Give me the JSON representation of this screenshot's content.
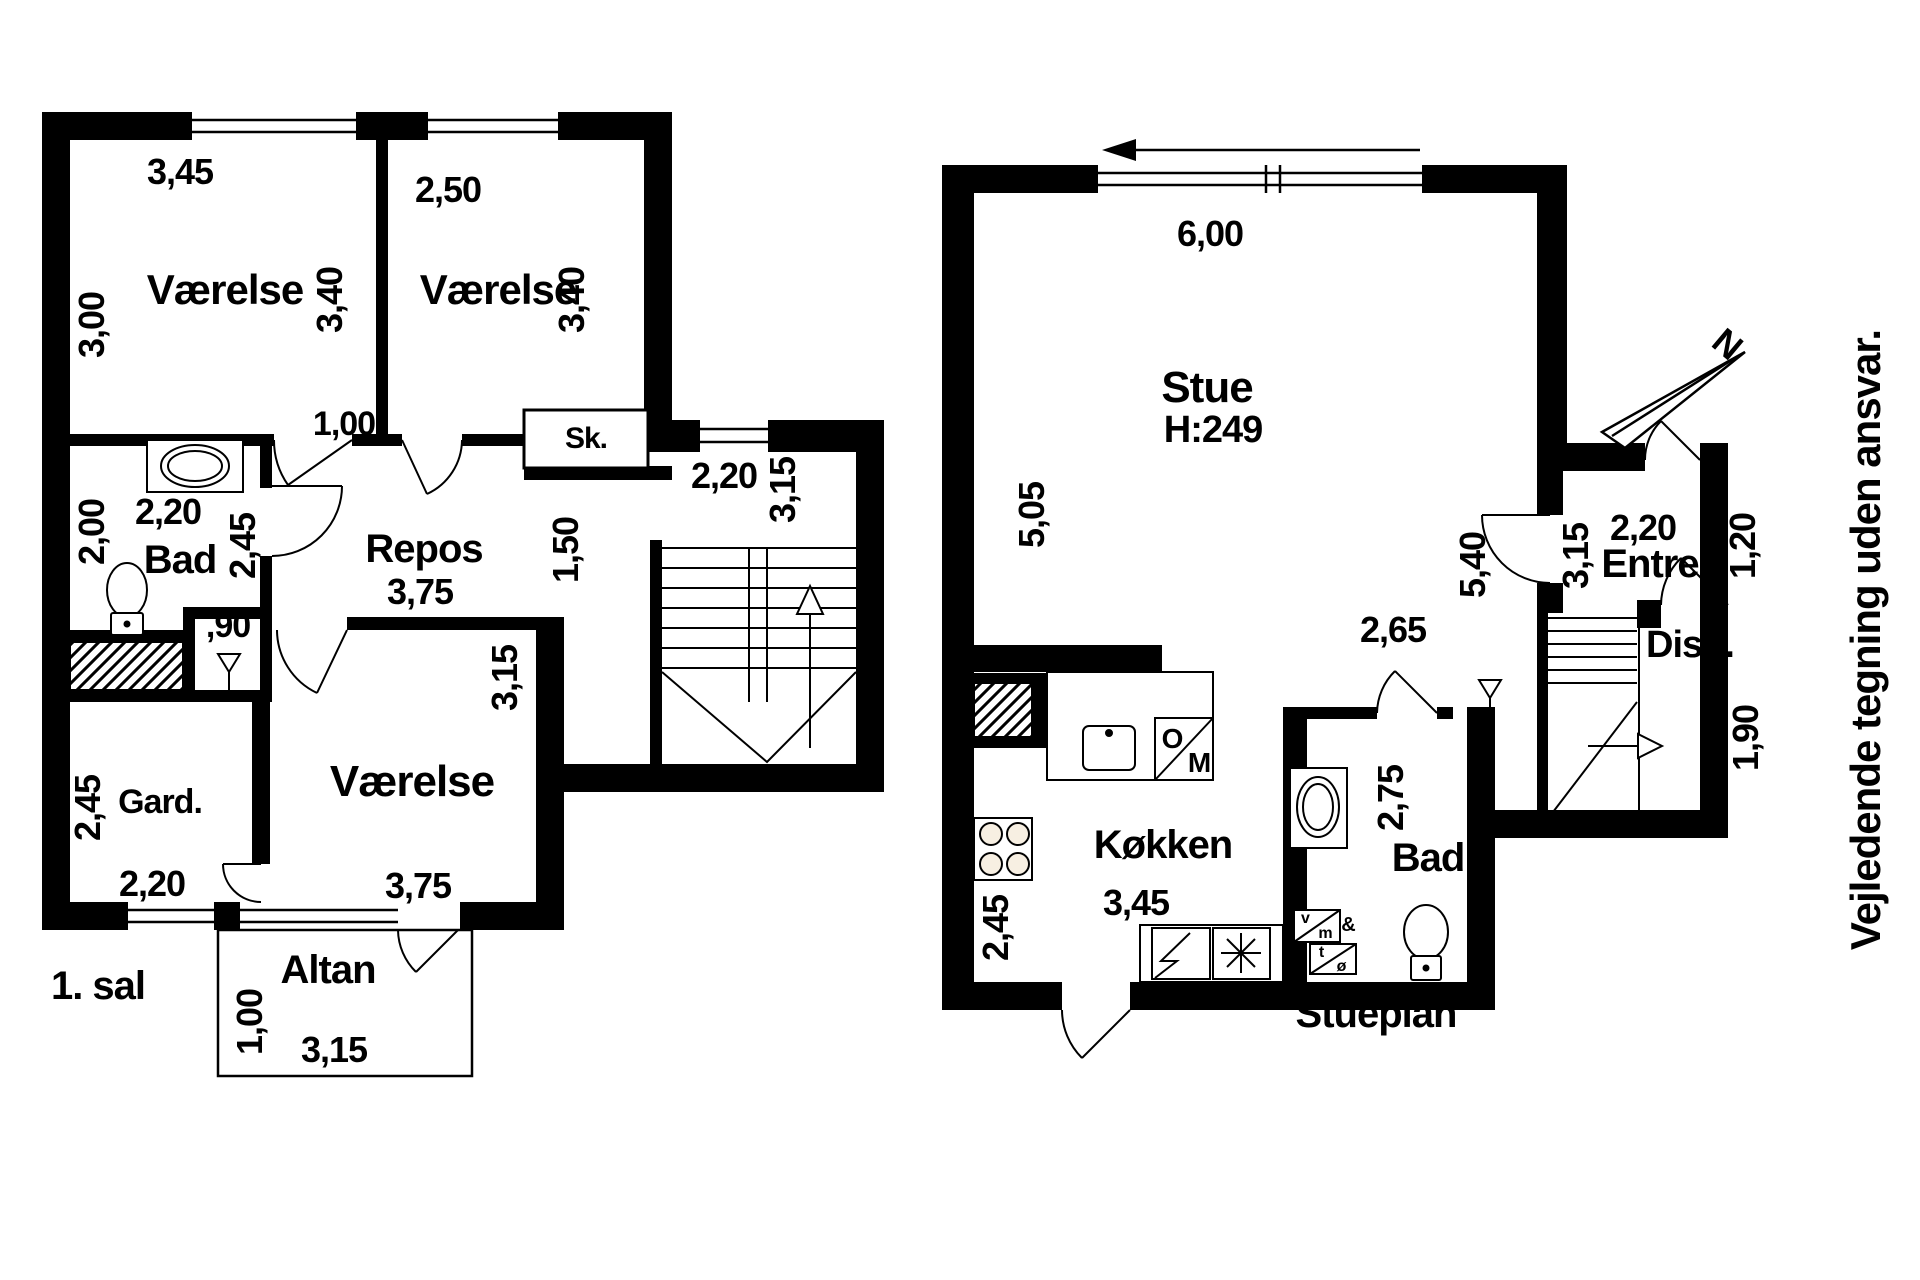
{
  "drawing_type": "floor-plan",
  "colors": {
    "ink": "#000000",
    "paper": "#ffffff",
    "burner_fill": "#f7efe2"
  },
  "first_floor": {
    "title": "1. sal",
    "labels": [
      {
        "name": "room1-width-dim",
        "text": "3,45",
        "x": 180,
        "y": 172,
        "size": 36
      },
      {
        "name": "room1-label",
        "text": "Værelse",
        "x": 225,
        "y": 290,
        "size": 42
      },
      {
        "name": "room1-depth-dim",
        "text": "3,00",
        "x": 92,
        "y": 325,
        "size": 36,
        "rot": -90
      },
      {
        "name": "room1-right-dim",
        "text": "3,40",
        "x": 330,
        "y": 300,
        "size": 36,
        "rot": -90
      },
      {
        "name": "room2-width-dim",
        "text": "2,50",
        "x": 448,
        "y": 190,
        "size": 36
      },
      {
        "name": "room2-label",
        "text": "Værelse",
        "x": 498,
        "y": 290,
        "size": 42
      },
      {
        "name": "room2-right-dim",
        "text": "3,40",
        "x": 572,
        "y": 300,
        "size": 36,
        "rot": -90
      },
      {
        "name": "closet-label",
        "text": "Sk.",
        "x": 586,
        "y": 439,
        "size": 30
      },
      {
        "name": "door-width-dim",
        "text": "1,00",
        "x": 344,
        "y": 424,
        "size": 34
      },
      {
        "name": "bath1-width-dim",
        "text": "2,20",
        "x": 168,
        "y": 512,
        "size": 36
      },
      {
        "name": "bath1-label",
        "text": "Bad",
        "x": 180,
        "y": 560,
        "size": 40
      },
      {
        "name": "bath1-left-dim",
        "text": "2,00",
        "x": 92,
        "y": 532,
        "size": 36,
        "rot": -90
      },
      {
        "name": "bath1-right-dim",
        "text": "2,45",
        "x": 243,
        "y": 546,
        "size": 36,
        "rot": -90
      },
      {
        "name": "niche-width-dim",
        "text": ",90",
        "x": 228,
        "y": 626,
        "size": 34
      },
      {
        "name": "repos-label",
        "text": "Repos",
        "x": 424,
        "y": 549,
        "size": 40
      },
      {
        "name": "repos-width-dim",
        "text": "3,75",
        "x": 420,
        "y": 592,
        "size": 36
      },
      {
        "name": "corridor-dim",
        "text": "1,50",
        "x": 566,
        "y": 550,
        "size": 36,
        "rot": -90
      },
      {
        "name": "stair-width-dim",
        "text": "2,20",
        "x": 724,
        "y": 476,
        "size": 36
      },
      {
        "name": "stair-depth-dim",
        "text": "3,15",
        "x": 783,
        "y": 490,
        "size": 36,
        "rot": -90
      },
      {
        "name": "gard-label",
        "text": "Gard.",
        "x": 160,
        "y": 802,
        "size": 34
      },
      {
        "name": "gard-depth-dim",
        "text": "2,45",
        "x": 88,
        "y": 808,
        "size": 36,
        "rot": -90
      },
      {
        "name": "gard-width-dim",
        "text": "2,20",
        "x": 152,
        "y": 884,
        "size": 36
      },
      {
        "name": "room3-label",
        "text": "Værelse",
        "x": 412,
        "y": 782,
        "size": 44
      },
      {
        "name": "room3-width-dim",
        "text": "3,75",
        "x": 418,
        "y": 886,
        "size": 36
      },
      {
        "name": "room3-right-dim",
        "text": "3,15",
        "x": 505,
        "y": 678,
        "size": 36,
        "rot": -90
      },
      {
        "name": "altan-label",
        "text": "Altan",
        "x": 328,
        "y": 970,
        "size": 40
      },
      {
        "name": "altan-depth-dim",
        "text": "1,00",
        "x": 250,
        "y": 1022,
        "size": 36,
        "rot": -90
      },
      {
        "name": "altan-width-dim",
        "text": "3,15",
        "x": 334,
        "y": 1050,
        "size": 36
      }
    ]
  },
  "ground_floor": {
    "title": "Stueplan",
    "labels": [
      {
        "name": "stue-width-dim",
        "text": "6,00",
        "x": 1210,
        "y": 234,
        "size": 36
      },
      {
        "name": "stue-label",
        "text": "Stue",
        "x": 1207,
        "y": 388,
        "size": 44
      },
      {
        "name": "ceiling-height-label",
        "text": "H:249",
        "x": 1213,
        "y": 430,
        "size": 38
      },
      {
        "name": "stue-left-dim",
        "text": "5,05",
        "x": 1032,
        "y": 515,
        "size": 36,
        "rot": -90
      },
      {
        "name": "stue-right-dim",
        "text": "5,40",
        "x": 1473,
        "y": 565,
        "size": 36,
        "rot": -90
      },
      {
        "name": "kitchen-label",
        "text": "Køkken",
        "x": 1163,
        "y": 845,
        "size": 40
      },
      {
        "name": "kitchen-width-dim",
        "text": "3,45",
        "x": 1136,
        "y": 903,
        "size": 36
      },
      {
        "name": "kitchen-depth-dim",
        "text": "2,45",
        "x": 996,
        "y": 928,
        "size": 36,
        "rot": -90
      },
      {
        "name": "bath2-width-dim",
        "text": "2,65",
        "x": 1393,
        "y": 630,
        "size": 36
      },
      {
        "name": "bath2-label",
        "text": "Bad",
        "x": 1428,
        "y": 858,
        "size": 40
      },
      {
        "name": "bath2-depth-dim",
        "text": "2,75",
        "x": 1391,
        "y": 798,
        "size": 36,
        "rot": -90
      },
      {
        "name": "entre-width-dim",
        "text": "2,20",
        "x": 1643,
        "y": 528,
        "size": 36
      },
      {
        "name": "entre-label",
        "text": "Entre",
        "x": 1650,
        "y": 564,
        "size": 40
      },
      {
        "name": "entre-left-dim",
        "text": "3,15",
        "x": 1576,
        "y": 556,
        "size": 36,
        "rot": -90
      },
      {
        "name": "entre-right-dim",
        "text": "1,20",
        "x": 1743,
        "y": 546,
        "size": 36,
        "rot": -90
      },
      {
        "name": "disp-label",
        "text": "Disp.",
        "x": 1690,
        "y": 645,
        "size": 38
      },
      {
        "name": "disp-depth-dim",
        "text": "1,90",
        "x": 1746,
        "y": 738,
        "size": 36,
        "rot": -90
      },
      {
        "name": "oven-letter-o",
        "text": "O",
        "x": 1172,
        "y": 739,
        "size": 28
      },
      {
        "name": "oven-letter-m",
        "text": "M",
        "x": 1199,
        "y": 763,
        "size": 28
      },
      {
        "name": "washer-letter-v",
        "text": "v",
        "x": 1305,
        "y": 919,
        "size": 16
      },
      {
        "name": "washer-letter-m",
        "text": "m",
        "x": 1325,
        "y": 934,
        "size": 16
      },
      {
        "name": "washer-amp",
        "text": "&",
        "x": 1348,
        "y": 925,
        "size": 20
      },
      {
        "name": "dryer-letter-t",
        "text": "t",
        "x": 1321,
        "y": 953,
        "size": 16
      },
      {
        "name": "dryer-letter-o",
        "text": "ø",
        "x": 1341,
        "y": 967,
        "size": 16
      }
    ]
  },
  "annotations": {
    "disclaimer": "Vejledende tegning uden ansvar.",
    "north_letter": "N"
  }
}
